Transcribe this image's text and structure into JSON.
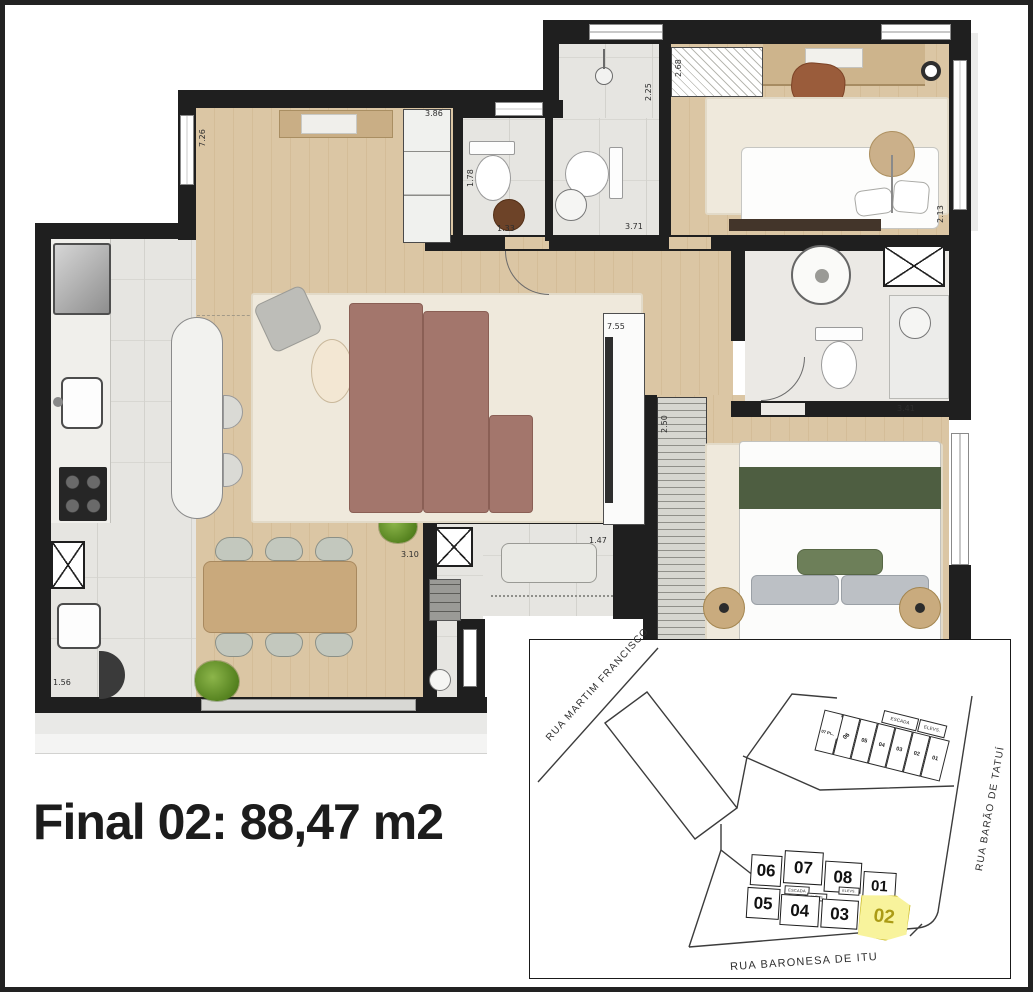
{
  "title": {
    "text": "Final 02: 88,47 m2"
  },
  "floor_plan": {
    "dimensions": [
      {
        "value": "3.86"
      },
      {
        "value": "7.26"
      },
      {
        "value": "2.25"
      },
      {
        "value": "1.78"
      },
      {
        "value": "1.33"
      },
      {
        "value": "3.71"
      },
      {
        "value": "2.68"
      },
      {
        "value": "2.13"
      },
      {
        "value": "7.55"
      },
      {
        "value": "3.41"
      },
      {
        "value": "2.50"
      },
      {
        "value": "3.10"
      },
      {
        "value": "1.47"
      },
      {
        "value": "1.56"
      }
    ]
  },
  "site_plan": {
    "streets": [
      {
        "name": "RUA MARTIM FRANCISCO"
      },
      {
        "name": "RUA BARÃO DE TATUÍ"
      },
      {
        "name": "RUA BARONESA DE ITU"
      }
    ],
    "tower": {
      "units": [
        {
          "label": "07 PCD"
        },
        {
          "label": "06"
        },
        {
          "label": "05"
        },
        {
          "label": "04"
        },
        {
          "label": "03"
        },
        {
          "label": "02"
        },
        {
          "label": "01"
        }
      ],
      "core": [
        {
          "label": "ESCADA"
        },
        {
          "label": "ELEVS."
        }
      ]
    },
    "cluster": {
      "top_row": [
        {
          "label": "06"
        },
        {
          "label": "07"
        },
        {
          "label": "08"
        },
        {
          "label": "01"
        }
      ],
      "bottom_row": [
        {
          "label": "05"
        },
        {
          "label": "04"
        },
        {
          "label": "03"
        }
      ],
      "highlighted": {
        "label": "02"
      },
      "core": [
        {
          "label": "ESCADA"
        },
        {
          "label": "ELEVS."
        },
        {
          "label": "ELEVS."
        }
      ]
    },
    "highlight_color": "#f8f39c"
  },
  "colors": {
    "wall": "#1f1f1f",
    "wood_floor": "#d9c29e",
    "tile_floor": "#e6e5e1",
    "rug": "#efe9dc",
    "sofa": "#a3766c",
    "bed_green": "#4e5e41",
    "highlight_unit": "#f8f39c",
    "highlight_text": "#ab9b15"
  }
}
